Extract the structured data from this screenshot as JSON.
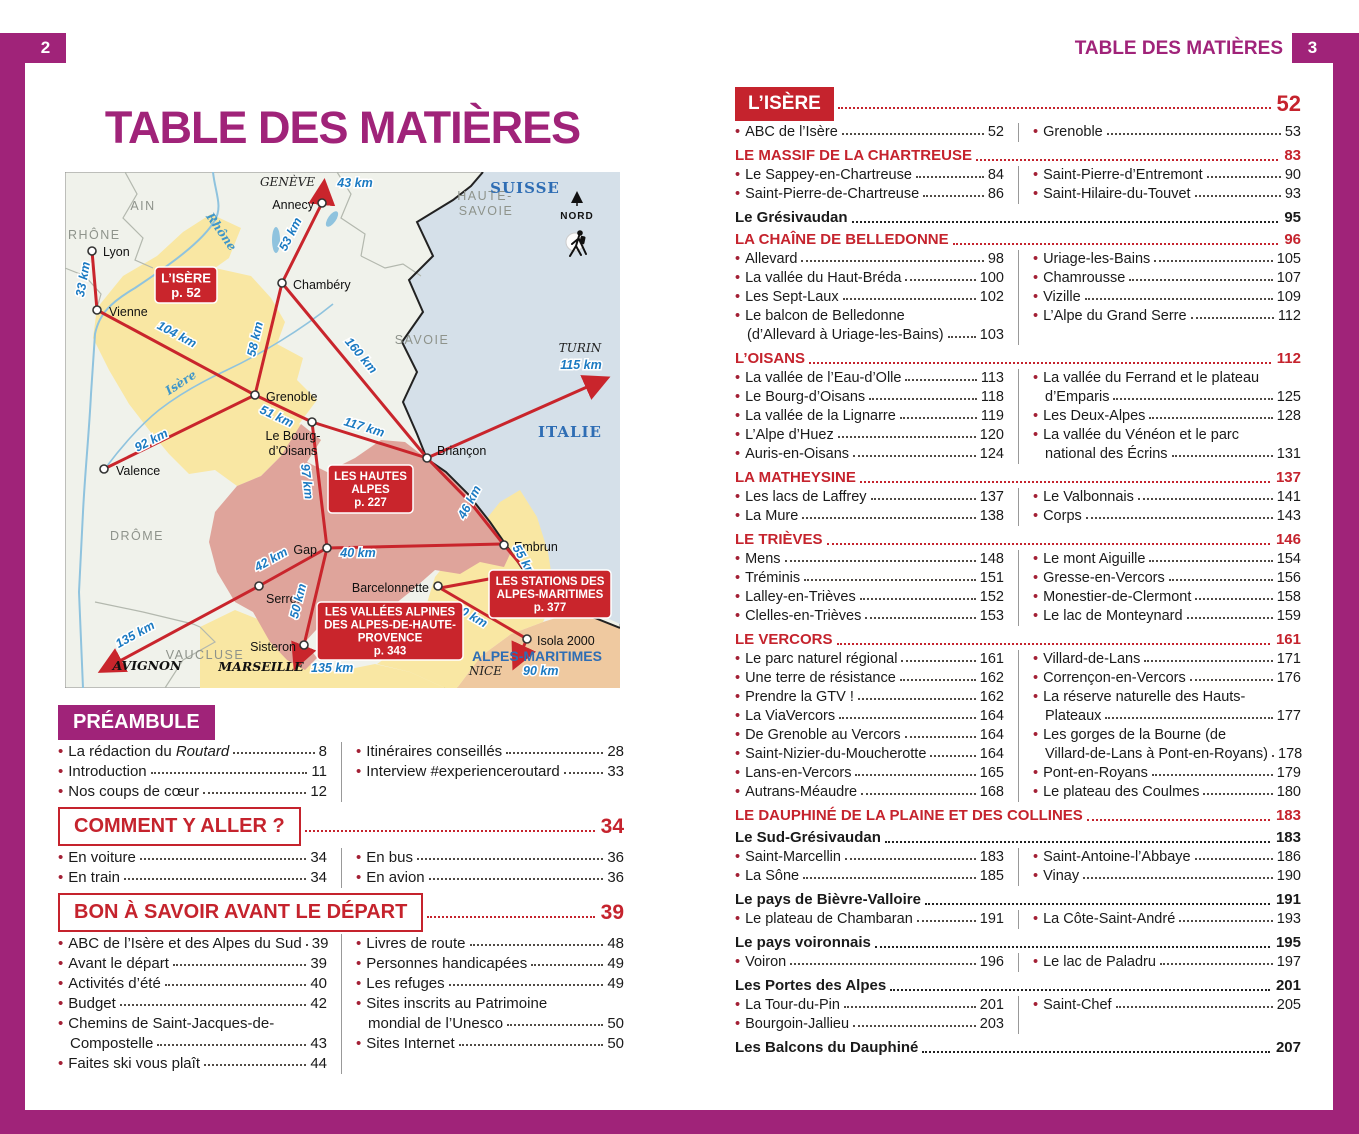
{
  "colors": {
    "magenta": "#A02379",
    "red": "#C5232D",
    "map_red": "#C9252C",
    "map_blue_label": "#2E6DB4",
    "distance_blue": "#1B7AC2"
  },
  "left_page": {
    "page_number": "2",
    "title": "TABLE DES MATIÈRES",
    "map": {
      "cities": [
        {
          "n": "Lyon",
          "x": 27,
          "y": 79,
          "lx": 38,
          "ly": 84,
          "a": "s"
        },
        {
          "n": "Vienne",
          "x": 32,
          "y": 138,
          "lx": 44,
          "ly": 144,
          "a": "s"
        },
        {
          "n": "Valence",
          "x": 39,
          "y": 297,
          "lx": 51,
          "ly": 303,
          "a": "s"
        },
        {
          "n": "Annecy",
          "x": 257,
          "y": 31,
          "lx": 249,
          "ly": 37,
          "a": "e"
        },
        {
          "n": "Chambéry",
          "x": 217,
          "y": 111,
          "lx": 228,
          "ly": 117,
          "a": "s"
        },
        {
          "n": "Grenoble",
          "x": 190,
          "y": 223,
          "lx": 201,
          "ly": 229,
          "a": "s"
        },
        {
          "n": "Le Bourg-",
          "n2": "d’Oisans",
          "x": 247,
          "y": 250,
          "lx": 228,
          "ly": 268,
          "a": "m"
        },
        {
          "n": "Briançon",
          "x": 362,
          "y": 286,
          "lx": 372,
          "ly": 283,
          "a": "s"
        },
        {
          "n": "Gap",
          "x": 262,
          "y": 376,
          "lx": 252,
          "ly": 382,
          "a": "e"
        },
        {
          "n": "Embrun",
          "x": 439,
          "y": 373,
          "lx": 449,
          "ly": 379,
          "a": "s"
        },
        {
          "n": "Serres",
          "x": 194,
          "y": 414,
          "lx": 201,
          "ly": 431,
          "a": "s"
        },
        {
          "n": "Sisteron",
          "x": 239,
          "y": 473,
          "lx": 231,
          "ly": 479,
          "a": "e"
        },
        {
          "n": "Barcelonnette",
          "x": 373,
          "y": 414,
          "lx": 364,
          "ly": 420,
          "a": "e"
        },
        {
          "n": "Isola 2000",
          "x": 462,
          "y": 467,
          "lx": 472,
          "ly": 473,
          "a": "s"
        }
      ],
      "labels": [
        {
          "t": "AIN",
          "x": 78,
          "y": 38,
          "c": "rg"
        },
        {
          "t": "RHÔNE",
          "x": 3,
          "y": 67,
          "c": "rg",
          "a": "s"
        },
        {
          "t": "HAUTE-",
          "x": 420,
          "y": 28,
          "c": "rg"
        },
        {
          "t": "SAVOIE",
          "x": 421,
          "y": 43,
          "c": "rg"
        },
        {
          "t": "SAVOIE",
          "x": 357,
          "y": 172,
          "c": "rg"
        },
        {
          "t": "DRÔME",
          "x": 72,
          "y": 368,
          "c": "rg"
        },
        {
          "t": "VAUCLUSE",
          "x": 140,
          "y": 487,
          "c": "rg"
        },
        {
          "t": "SUISSE",
          "x": 460,
          "y": 21,
          "c": "rb"
        },
        {
          "t": "ITALIE",
          "x": 505,
          "y": 265,
          "c": "rb"
        },
        {
          "t": "ALPES-MARITIMES",
          "x": 472,
          "y": 489,
          "c": "rbs"
        },
        {
          "t": "NORD",
          "x": 512,
          "y": 47,
          "c": "nord"
        },
        {
          "t": "GENÈVE",
          "x": 250,
          "y": 14,
          "c": "dest",
          "a": "e"
        },
        {
          "t": "TURIN",
          "x": 515,
          "y": 180,
          "c": "dest"
        },
        {
          "t": "NICE",
          "x": 437,
          "y": 503,
          "c": "dest",
          "a": "e"
        },
        {
          "t": "AVIGNON",
          "x": 82,
          "y": 498,
          "c": "destb"
        },
        {
          "t": "MARSEILLE",
          "x": 196,
          "y": 499,
          "c": "destb"
        },
        {
          "t": "Rhône",
          "x": 153,
          "y": 62,
          "c": "riv",
          "r": 55
        },
        {
          "t": "Isère",
          "x": 118,
          "y": 214,
          "c": "riv",
          "r": -33
        },
        {
          "t": "43 km",
          "x": 290,
          "y": 15,
          "c": "d"
        },
        {
          "t": "33 km",
          "x": 22,
          "y": 108,
          "c": "d",
          "r": -80
        },
        {
          "t": "104 km",
          "x": 110,
          "y": 166,
          "c": "d",
          "r": 28
        },
        {
          "t": "53 km",
          "x": 229,
          "y": 64,
          "c": "d",
          "r": -63
        },
        {
          "t": "58 km",
          "x": 194,
          "y": 168,
          "c": "d",
          "r": -77
        },
        {
          "t": "160 km",
          "x": 293,
          "y": 186,
          "c": "d",
          "r": 50
        },
        {
          "t": "51 km",
          "x": 210,
          "y": 248,
          "c": "d",
          "r": 25
        },
        {
          "t": "117 km",
          "x": 298,
          "y": 259,
          "c": "d",
          "r": 17
        },
        {
          "t": "92 km",
          "x": 88,
          "y": 272,
          "c": "d",
          "r": -27
        },
        {
          "t": "97 km",
          "x": 238,
          "y": 310,
          "c": "d",
          "r": 83
        },
        {
          "t": "46 km",
          "x": 408,
          "y": 332,
          "c": "d",
          "r": -62
        },
        {
          "t": "40 km",
          "x": 293,
          "y": 385,
          "c": "d"
        },
        {
          "t": "42 km",
          "x": 208,
          "y": 391,
          "c": "d",
          "r": -29
        },
        {
          "t": "50 km",
          "x": 237,
          "y": 430,
          "c": "d",
          "r": -76
        },
        {
          "t": "55 km",
          "x": 456,
          "y": 391,
          "c": "d",
          "r": 60
        },
        {
          "t": "80 km",
          "x": 404,
          "y": 447,
          "c": "d",
          "r": 30
        },
        {
          "t": "115 km",
          "x": 516,
          "y": 197,
          "c": "d"
        },
        {
          "t": "135 km",
          "x": 72,
          "y": 466,
          "c": "d",
          "r": -29
        },
        {
          "t": "135 km",
          "x": 246,
          "y": 500,
          "c": "d",
          "a": "s"
        },
        {
          "t": "90 km",
          "x": 458,
          "y": 503,
          "c": "d",
          "a": "s"
        }
      ],
      "boxes": [
        {
          "lines": [
            "L’ISÈRE"
          ],
          "page": "p. 52",
          "x": 90,
          "y": 95,
          "w": 62,
          "h": 36,
          "fs": 13
        },
        {
          "lines": [
            "LES HAUTES",
            "ALPES"
          ],
          "page": "p. 227",
          "x": 263,
          "y": 293,
          "w": 85,
          "h": 48,
          "fs": 11.5
        },
        {
          "lines": [
            "LES VALLÉES ALPINES",
            "DES ALPES-DE-HAUTE-",
            "PROVENCE"
          ],
          "page": "p. 343",
          "x": 252,
          "y": 430,
          "w": 146,
          "h": 58,
          "fs": 11.5
        },
        {
          "lines": [
            "LES STATIONS DES",
            "ALPES-MARITIMES"
          ],
          "page": "p. 377",
          "x": 424,
          "y": 398,
          "w": 122,
          "h": 48,
          "fs": 11.5
        }
      ]
    },
    "sections": [
      {
        "style": "preamble",
        "title": "PRÉAMBULE",
        "cols": {
          "left": [
            {
              "l1": "La rédaction du ",
              "it": "Routard",
              "p": "8"
            },
            {
              "l1": "Introduction",
              "p": "11"
            },
            {
              "l1": "Nos coups de cœur",
              "p": "12"
            }
          ],
          "right": [
            {
              "l1": "Itinéraires conseillés",
              "p": "28"
            },
            {
              "l1": "Interview #experienceroutard",
              "p": "33"
            }
          ]
        }
      },
      {
        "style": "outline",
        "title": "COMMENT Y ALLER ?",
        "page": "34",
        "cols": {
          "left": [
            {
              "l1": "En voiture",
              "p": "34"
            },
            {
              "l1": "En train",
              "p": "34"
            }
          ],
          "right": [
            {
              "l1": "En bus",
              "p": "36"
            },
            {
              "l1": "En avion",
              "p": "36"
            }
          ]
        }
      },
      {
        "style": "outline",
        "title": "BON À SAVOIR AVANT LE DÉPART",
        "page": "39",
        "cols": {
          "left": [
            {
              "l1": "ABC de l’Isère et des Alpes du Sud",
              "p": "39"
            },
            {
              "l1": "Avant le départ",
              "p": "39"
            },
            {
              "l1": "Activités d’été",
              "p": "40"
            },
            {
              "l1": "Budget",
              "p": "42"
            },
            {
              "l1": "Chemins de Saint-Jacques-de-",
              "l2": "Compostelle",
              "p": "43"
            },
            {
              "l1": "Faites ski vous plaît",
              "p": "44"
            }
          ],
          "right": [
            {
              "l1": "Livres de route",
              "p": "48"
            },
            {
              "l1": "Personnes handicapées",
              "p": "49"
            },
            {
              "l1": "Les refuges",
              "p": "49"
            },
            {
              "l1": "Sites inscrits au Patrimoine",
              "l2": "mondial de l’Unesco",
              "p": "50"
            },
            {
              "l1": "Sites Internet",
              "p": "50"
            }
          ]
        }
      }
    ]
  },
  "right_page": {
    "page_number": "3",
    "header": "TABLE DES MATIÈRES",
    "sections": [
      {
        "style": "redfill",
        "title": "L’ISÈRE",
        "page": "52",
        "cols": {
          "left": [
            {
              "l1": "ABC de l’Isère",
              "p": "52"
            }
          ],
          "right": [
            {
              "l1": "Grenoble",
              "p": "53"
            }
          ]
        }
      },
      {
        "style": "redcaps",
        "title": "LE MASSIF DE LA CHARTREUSE",
        "page": "83",
        "cols": {
          "left": [
            {
              "l1": "Le Sappey-en-Chartreuse",
              "p": "84"
            },
            {
              "l1": "Saint-Pierre-de-Chartreuse",
              "p": "86"
            }
          ],
          "right": [
            {
              "l1": "Saint-Pierre-d’Entremont",
              "p": "90"
            },
            {
              "l1": "Saint-Hilaire-du-Touvet",
              "p": "93"
            }
          ]
        }
      },
      {
        "style": "black",
        "title": "Le Grésivaudan",
        "page": "95"
      },
      {
        "style": "redcaps",
        "title": "LA CHAÎNE DE BELLEDONNE",
        "page": "96",
        "cols": {
          "left": [
            {
              "l1": "Allevard",
              "p": "98"
            },
            {
              "l1": "La vallée du Haut-Bréda",
              "p": "100"
            },
            {
              "l1": "Les Sept-Laux",
              "p": "102"
            },
            {
              "l1": "Le balcon de Belledonne",
              "l2": "(d’Allevard à Uriage-les-Bains)",
              "p": "103"
            }
          ],
          "right": [
            {
              "l1": "Uriage-les-Bains",
              "p": "105"
            },
            {
              "l1": "Chamrousse",
              "p": "107"
            },
            {
              "l1": "Vizille",
              "p": "109"
            },
            {
              "l1": "L’Alpe du Grand Serre",
              "p": "112"
            }
          ]
        }
      },
      {
        "style": "redcaps",
        "title": "L’OISANS",
        "page": "112",
        "cols": {
          "left": [
            {
              "l1": "La vallée de l’Eau-d’Olle",
              "p": "113"
            },
            {
              "l1": "Le Bourg-d’Oisans",
              "p": "118"
            },
            {
              "l1": "La vallée de la Lignarre",
              "p": "119"
            },
            {
              "l1": "L’Alpe d’Huez",
              "p": "120"
            },
            {
              "l1": "Auris-en-Oisans",
              "p": "124"
            }
          ],
          "right": [
            {
              "l1": "La vallée du Ferrand et le plateau",
              "l2": "d’Emparis",
              "p": "125"
            },
            {
              "l1": "Les Deux-Alpes",
              "p": "128"
            },
            {
              "l1": "La vallée du Vénéon et le parc",
              "l2": "national des Écrins",
              "p": "131"
            }
          ]
        }
      },
      {
        "style": "redcaps",
        "title": "LA MATHEYSINE",
        "page": "137",
        "cols": {
          "left": [
            {
              "l1": "Les lacs de Laffrey",
              "p": "137"
            },
            {
              "l1": "La Mure",
              "p": "138"
            }
          ],
          "right": [
            {
              "l1": "Le Valbonnais",
              "p": "141"
            },
            {
              "l1": "Corps",
              "p": "143"
            }
          ]
        }
      },
      {
        "style": "redcaps",
        "title": "LE TRIÈVES",
        "page": "146",
        "cols": {
          "left": [
            {
              "l1": "Mens",
              "p": "148"
            },
            {
              "l1": "Tréminis",
              "p": "151"
            },
            {
              "l1": "Lalley-en-Trièves",
              "p": "152"
            },
            {
              "l1": "Clelles-en-Trièves",
              "p": "153"
            }
          ],
          "right": [
            {
              "l1": "Le mont Aiguille",
              "p": "154"
            },
            {
              "l1": "Gresse-en-Vercors",
              "p": "156"
            },
            {
              "l1": "Monestier-de-Clermont",
              "p": "158"
            },
            {
              "l1": "Le lac de Monteynard",
              "p": "159"
            }
          ]
        }
      },
      {
        "style": "redcaps",
        "title": "LE VERCORS",
        "page": "161",
        "cols": {
          "left": [
            {
              "l1": "Le parc naturel régional",
              "p": "161"
            },
            {
              "l1": "Une terre de résistance",
              "p": "162"
            },
            {
              "l1": "Prendre la GTV !",
              "p": "162"
            },
            {
              "l1": "La ViaVercors",
              "p": "164"
            },
            {
              "l1": "De Grenoble au Vercors",
              "p": "164"
            },
            {
              "l1": "Saint-Nizier-du-Moucherotte",
              "p": "164"
            },
            {
              "l1": "Lans-en-Vercors",
              "p": "165"
            },
            {
              "l1": "Autrans-Méaudre",
              "p": "168"
            }
          ],
          "right": [
            {
              "l1": "Villard-de-Lans",
              "p": "171"
            },
            {
              "l1": "Corrençon-en-Vercors",
              "p": "176"
            },
            {
              "l1": "La réserve naturelle des Hauts-",
              "l2": "Plateaux",
              "p": "177"
            },
            {
              "l1": "Les gorges de la Bourne (de",
              "l2": "Villard-de-Lans à Pont-en-Royans)",
              "p": "178"
            },
            {
              "l1": "Pont-en-Royans",
              "p": "179"
            },
            {
              "l1": "Le plateau des Coulmes",
              "p": "180"
            }
          ]
        }
      },
      {
        "style": "redcaps",
        "title": "LE DAUPHINÉ DE LA PLAINE ET DES COLLINES",
        "page": "183"
      },
      {
        "style": "black",
        "title": "Le Sud-Grésivaudan",
        "page": "183",
        "cols": {
          "left": [
            {
              "l1": "Saint-Marcellin",
              "p": "183"
            },
            {
              "l1": "La Sône",
              "p": "185"
            }
          ],
          "right": [
            {
              "l1": "Saint-Antoine-l’Abbaye",
              "p": "186"
            },
            {
              "l1": "Vinay",
              "p": "190"
            }
          ]
        }
      },
      {
        "style": "black",
        "title": "Le pays de Bièvre-Valloire",
        "page": "191",
        "cols": {
          "left": [
            {
              "l1": "Le plateau de Chambaran",
              "p": "191"
            }
          ],
          "right": [
            {
              "l1": "La Côte-Saint-André",
              "p": "193"
            }
          ]
        }
      },
      {
        "style": "black",
        "title": "Le pays voironnais",
        "page": "195",
        "cols": {
          "left": [
            {
              "l1": "Voiron",
              "p": "196"
            }
          ],
          "right": [
            {
              "l1": "Le lac de Paladru",
              "p": "197"
            }
          ]
        }
      },
      {
        "style": "black",
        "title": "Les Portes des Alpes",
        "page": "201",
        "cols": {
          "left": [
            {
              "l1": "La Tour-du-Pin",
              "p": "201"
            },
            {
              "l1": "Bourgoin-Jallieu",
              "p": "203"
            }
          ],
          "right": [
            {
              "l1": "Saint-Chef",
              "p": "205"
            }
          ]
        }
      },
      {
        "style": "black",
        "title": "Les Balcons du Dauphiné",
        "page": "207"
      }
    ]
  }
}
